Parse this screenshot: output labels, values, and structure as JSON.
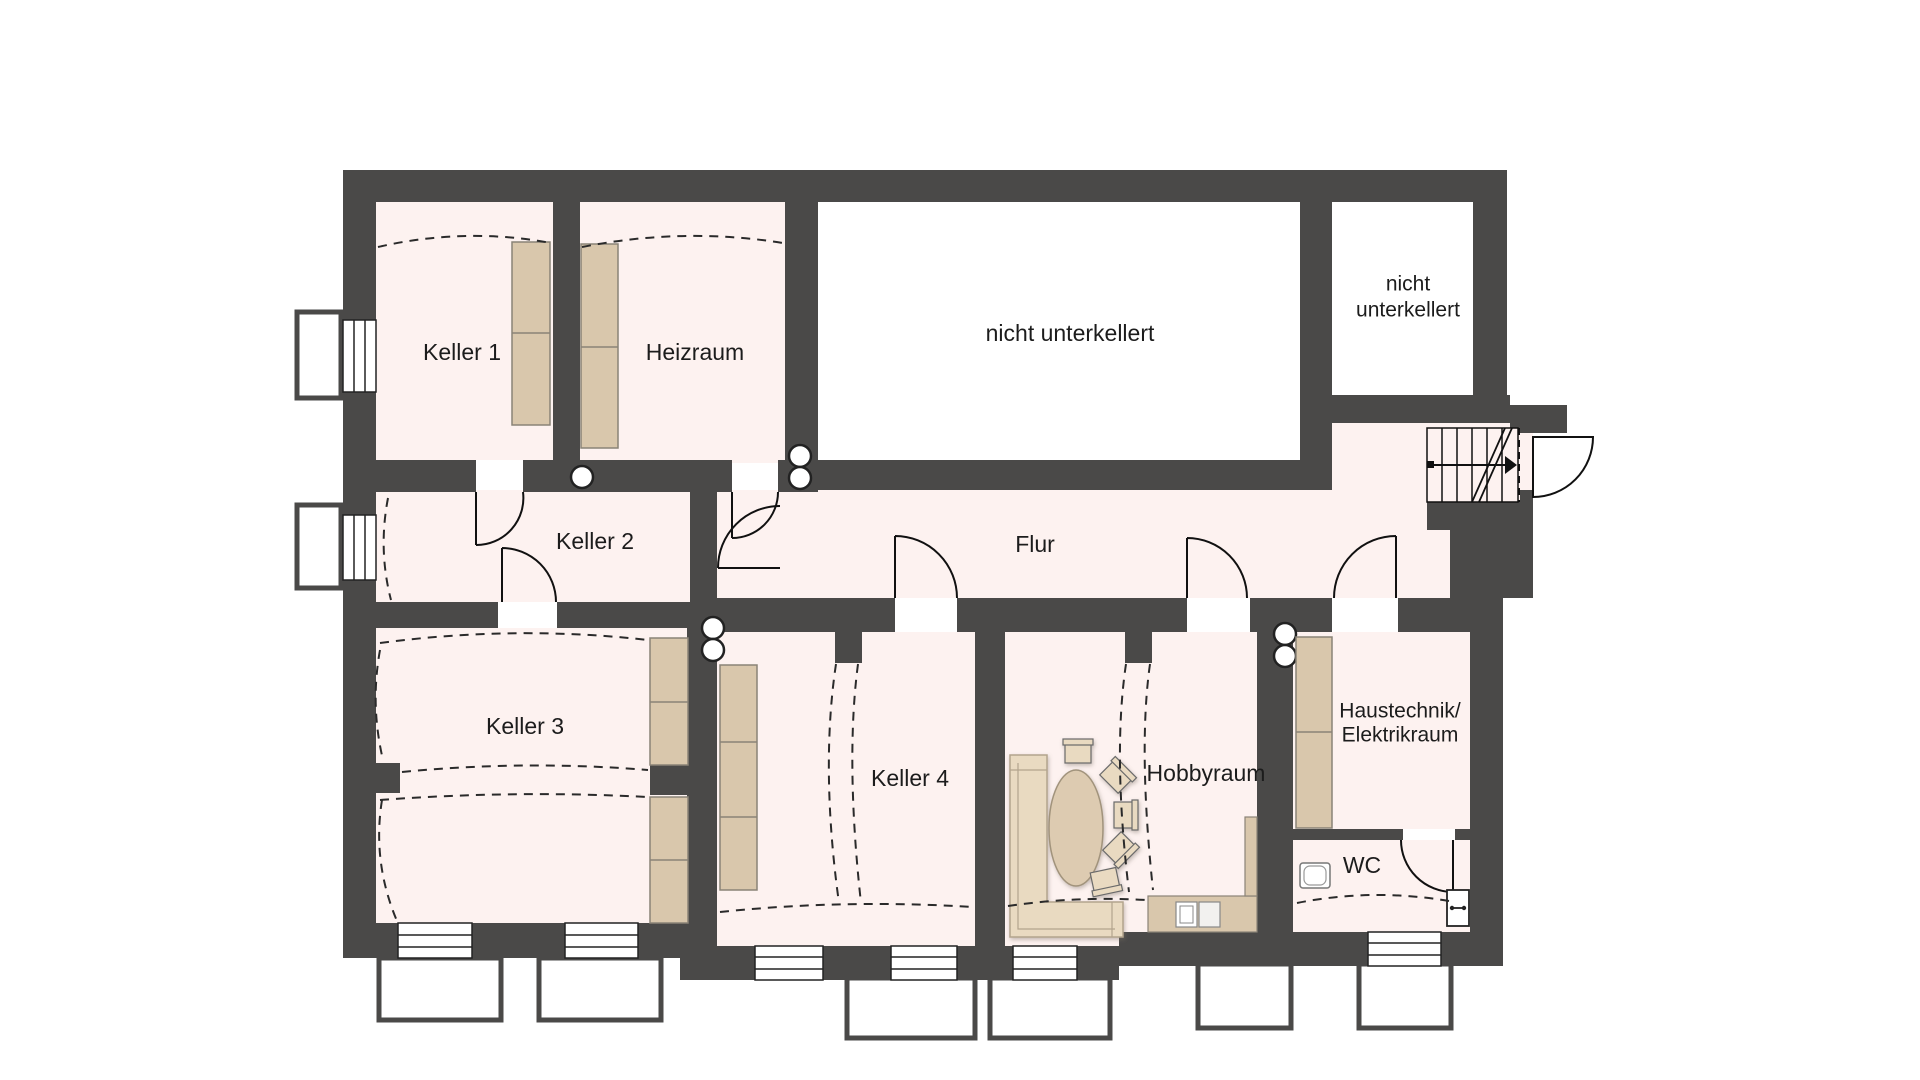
{
  "plan": {
    "title": "Kellergeschoss Grundriss",
    "rooms": {
      "keller1": {
        "label": "Keller 1"
      },
      "heizraum": {
        "label": "Heizraum"
      },
      "nicht_unterkellert_gross": {
        "label": "nicht unterkellert"
      },
      "nicht_unterkellert_klein": {
        "label_line1": "nicht",
        "label_line2": "unterkellert"
      },
      "keller2": {
        "label": "Keller 2"
      },
      "flur": {
        "label": "Flur"
      },
      "keller3": {
        "label": "Keller 3"
      },
      "keller4": {
        "label": "Keller 4"
      },
      "hobbyraum": {
        "label": "Hobbyraum"
      },
      "haustechnik": {
        "label_line1": "Haustechnik/",
        "label_line2": "Elektrikraum"
      },
      "wc": {
        "label": "WC"
      }
    },
    "colors": {
      "wall": "#4a4948",
      "room_fill": "#fdf2f0",
      "not_basemented_fill": "#ffffff",
      "shelf_fill": "#d9c7ac",
      "sofa_fill": "#e9dac1",
      "table_fill": "#ddcbb1",
      "line": "#111111"
    }
  }
}
